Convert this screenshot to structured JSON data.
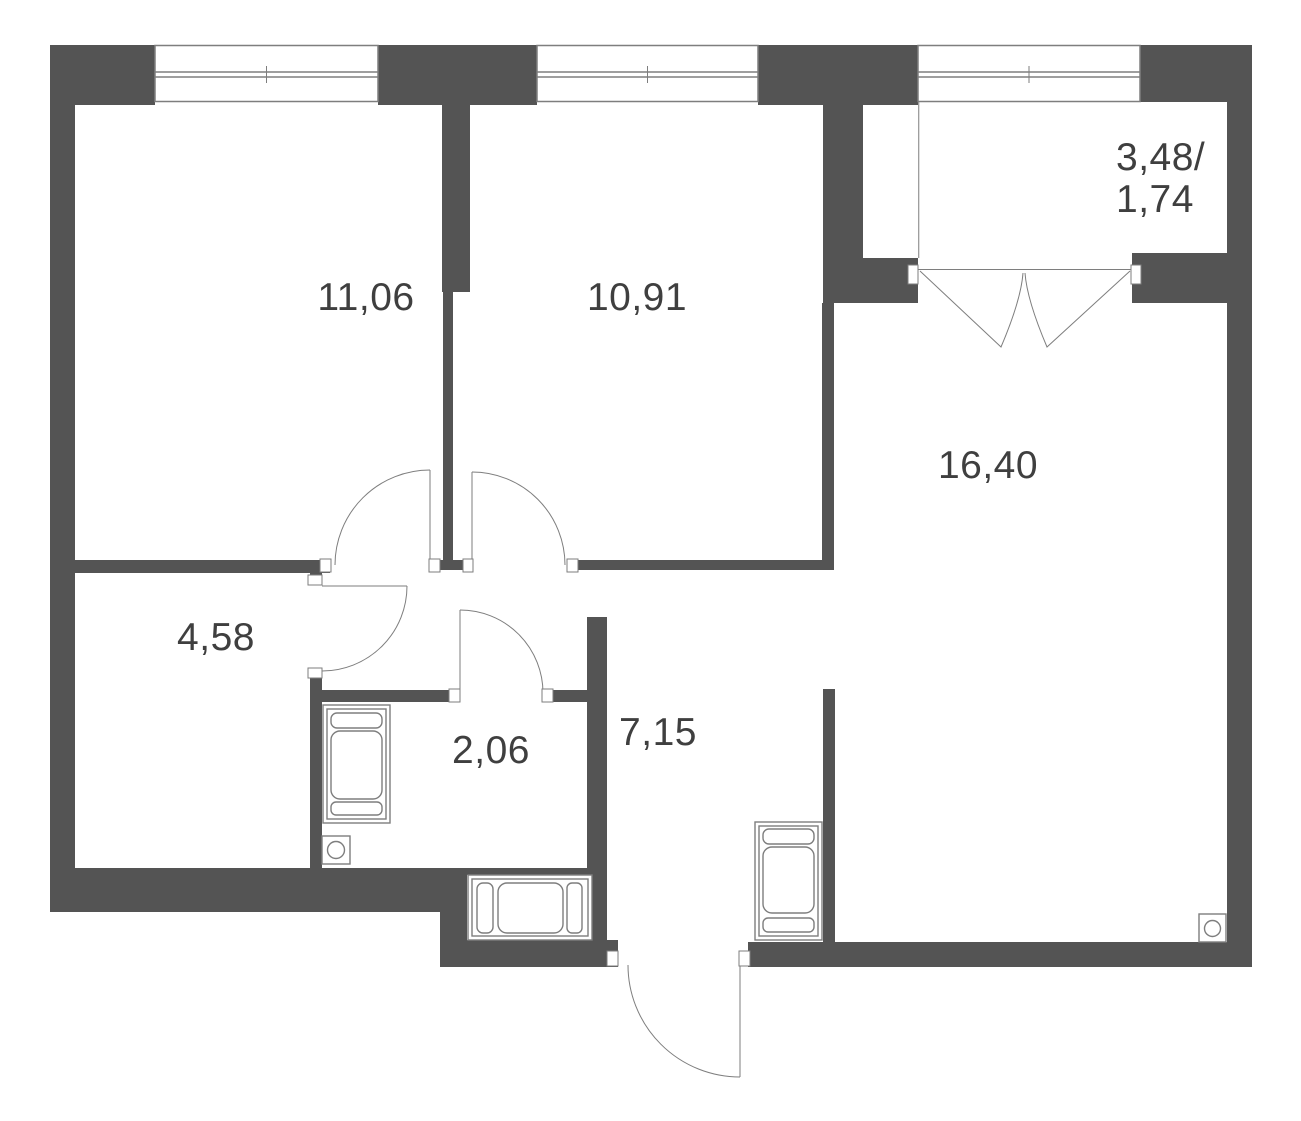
{
  "plan": {
    "title": "apartment-floor-plan",
    "rooms": [
      {
        "id": "room-11-06",
        "area": "11,06",
        "type": "bedroom"
      },
      {
        "id": "room-10-91",
        "area": "10,91",
        "type": "bedroom"
      },
      {
        "id": "room-16-40",
        "area": "16,40",
        "type": "kitchen-living-room"
      },
      {
        "id": "room-4-58",
        "area": "4,58",
        "type": "room"
      },
      {
        "id": "room-2-06",
        "area": "2,06",
        "type": "bathroom"
      },
      {
        "id": "room-7-15",
        "area": "7,15",
        "type": "hallway"
      },
      {
        "id": "balcony",
        "area_line1": "3,48/",
        "area_line2": "1,74",
        "type": "balcony"
      }
    ],
    "fixtures": {
      "bathroom_appliance": "washing-machine",
      "bathroom_sink": "sink",
      "hallway_cabinet": "cabinet",
      "niche_fixture": "bathtub",
      "kitchen_sink": "sink"
    },
    "colors": {
      "wall": "#545454",
      "line": "#7e7e7e",
      "text": "#3f3f3f",
      "bg": "#ffffff"
    }
  }
}
